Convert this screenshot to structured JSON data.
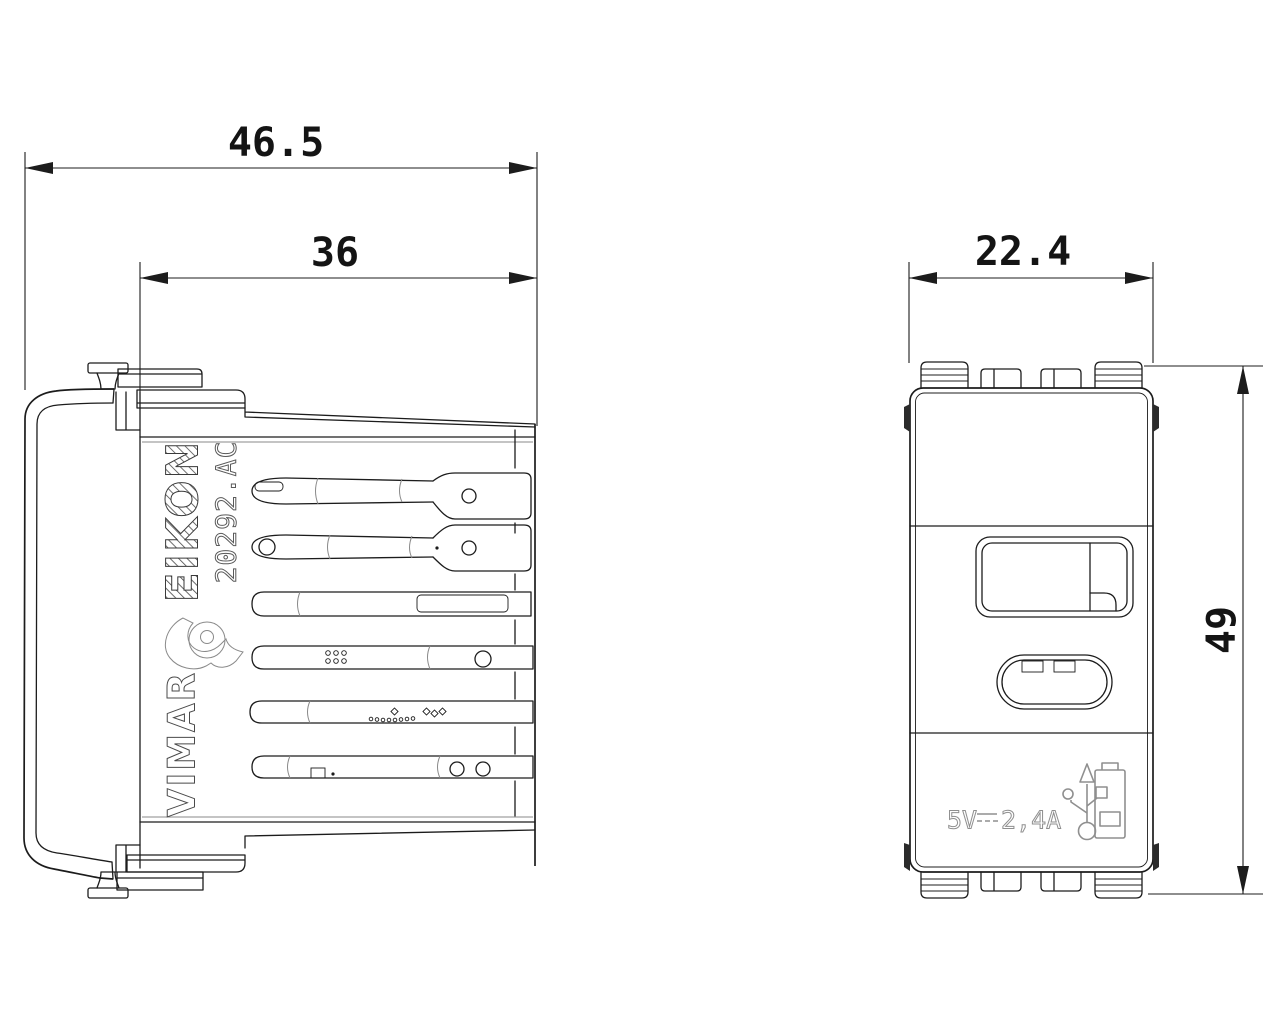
{
  "dimensions": {
    "overall_depth": "46.5",
    "module_depth": "36",
    "front_width": "22.4",
    "front_height": "49"
  },
  "side_view": {
    "brand": "EIKON",
    "product_code": "20292.AC",
    "manufacturer": "VIMAR",
    "icons": {
      "logo": "vimar-horn-logo"
    }
  },
  "front_view": {
    "marking": {
      "voltage": "5V",
      "dc_symbol": "⎓",
      "current": "2,4A"
    },
    "icons": {
      "usb": "usb-trident-icon",
      "battery": "battery-charging-icon"
    }
  },
  "colors": {
    "line": "#1c1c1c",
    "soft_line": "#8a8a8a",
    "marking": "#8f8f8f",
    "background": "#ffffff"
  }
}
